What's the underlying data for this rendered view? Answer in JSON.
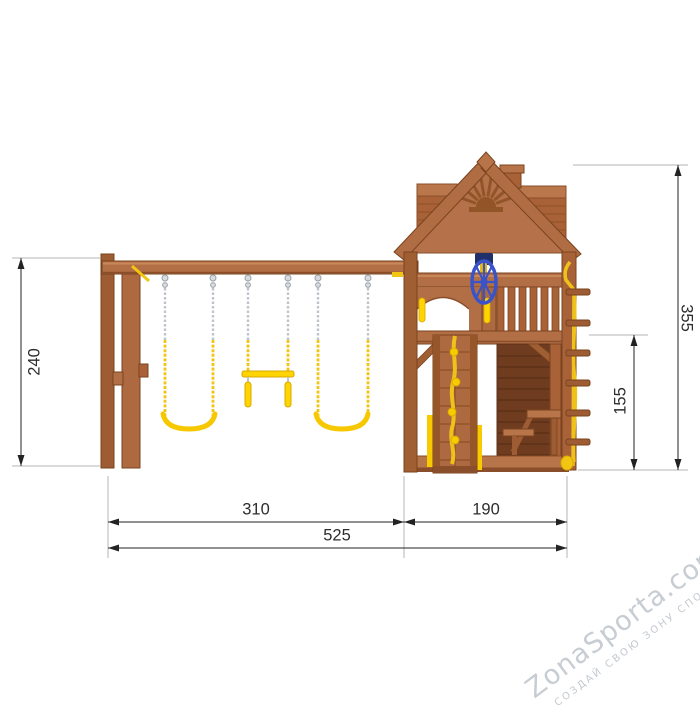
{
  "diagram": {
    "dimensions": {
      "swing_height": "240",
      "total_height": "355",
      "under_deck_height": "155",
      "swing_section_width": "310",
      "tower_section_width": "190",
      "total_width": "525"
    },
    "colors": {
      "wood_mid": "#b26f45",
      "wood_light": "#c9885a",
      "wood_dark": "#8a4e2a",
      "wood_edge": "#7a431f",
      "dark_wall": "#6f3c1f",
      "accent_yellow": "#f7c800",
      "rope_yellow": "#eec21a",
      "wheel_blue": "#3a53c9",
      "chain_silver": "#bfc4cb",
      "dimension_line": "#232323",
      "extension_line": "#b5b5b5",
      "watermark_gray": "#c7cdd3"
    }
  },
  "watermark": {
    "brand": "ZonaSporta.com",
    "tagline": "СОЗДАЙ СВОЮ ЗОНУ СПОРТА"
  }
}
